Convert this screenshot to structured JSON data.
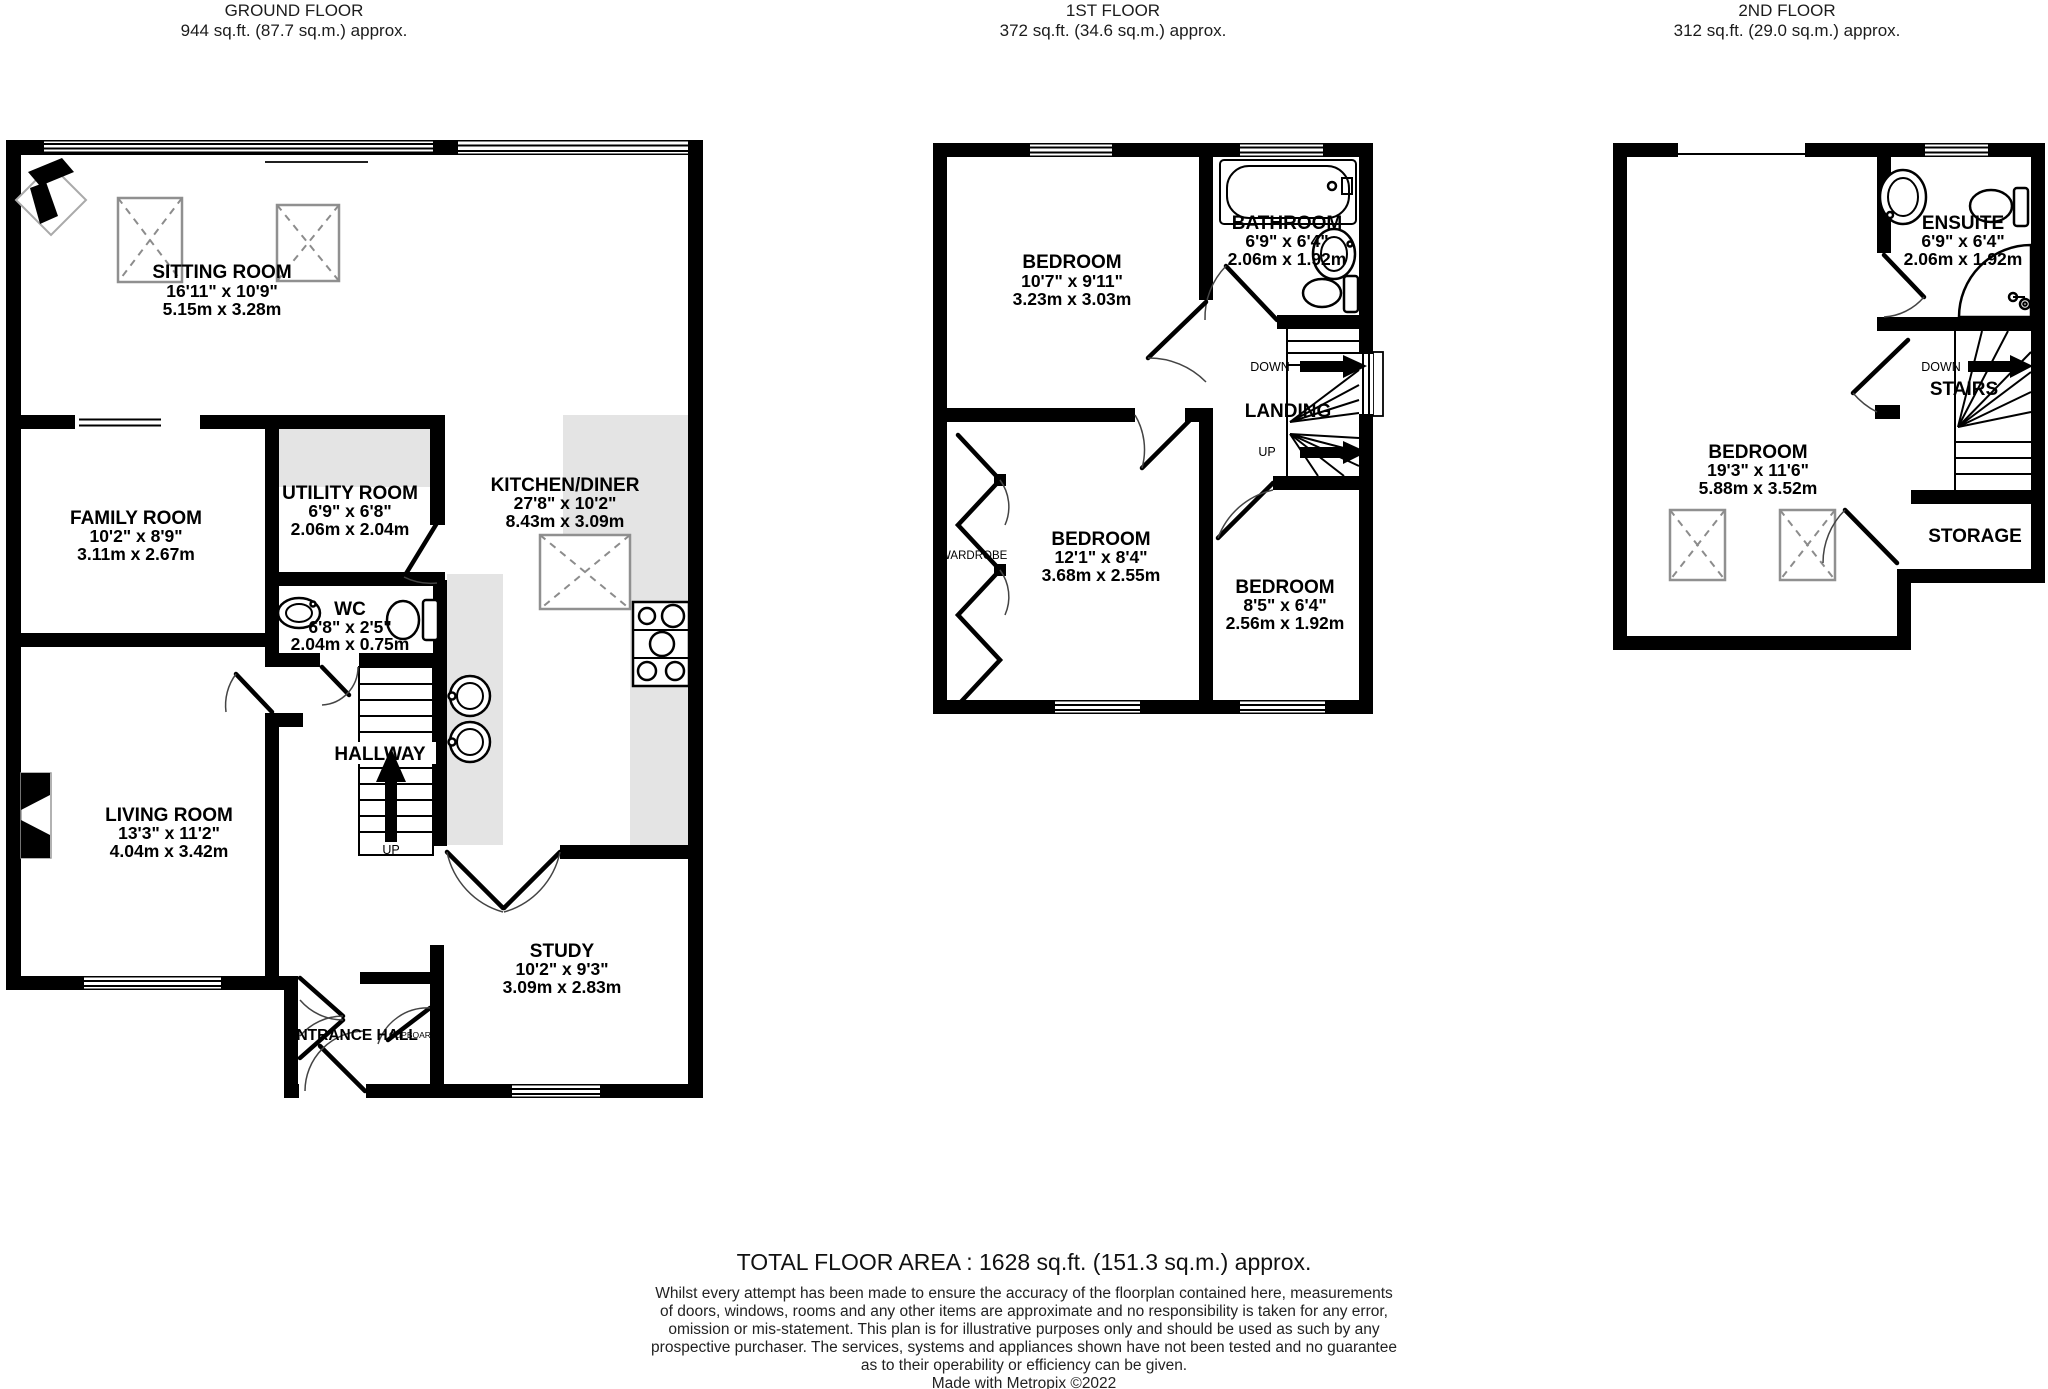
{
  "floors": [
    {
      "name": "GROUND FLOOR",
      "area": "944 sq.ft. (87.7 sq.m.) approx.",
      "rooms": [
        {
          "name": "SITTING ROOM",
          "imperial": "16'11\" x 10'9\"",
          "metric": "5.15m x 3.28m"
        },
        {
          "name": "FAMILY ROOM",
          "imperial": "10'2\" x 8'9\"",
          "metric": "3.11m x 2.67m"
        },
        {
          "name": "UTILITY ROOM",
          "imperial": "6'9\" x 6'8\"",
          "metric": "2.06m x 2.04m"
        },
        {
          "name": "KITCHEN/DINER",
          "imperial": "27'8\" x 10'2\"",
          "metric": "8.43m x 3.09m"
        },
        {
          "name": "WC",
          "imperial": "6'8\" x 2'5\"",
          "metric": "2.04m x 0.75m"
        },
        {
          "name": "LIVING ROOM",
          "imperial": "13'3\" x 11'2\"",
          "metric": "4.04m x 3.42m"
        },
        {
          "name": "STUDY",
          "imperial": "10'2\" x 9'3\"",
          "metric": "3.09m x 2.83m"
        }
      ],
      "labels": {
        "hallway": "HALLWAY",
        "up": "UP",
        "entrance_hall": "ENTRANCE HALL",
        "cupboard": "CUPBOARD"
      }
    },
    {
      "name": "1ST FLOOR",
      "area": "372 sq.ft. (34.6 sq.m.) approx.",
      "rooms": [
        {
          "name": "BEDROOM",
          "imperial": "10'7\" x 9'11\"",
          "metric": "3.23m x 3.03m"
        },
        {
          "name": "BATHROOM",
          "imperial": "6'9\" x 6'4\"",
          "metric": "2.06m x 1.92m"
        },
        {
          "name": "BEDROOM",
          "imperial": "12'1\" x 8'4\"",
          "metric": "3.68m x 2.55m"
        },
        {
          "name": "BEDROOM",
          "imperial": "8'5\" x 6'4\"",
          "metric": "2.56m x 1.92m"
        }
      ],
      "labels": {
        "down": "DOWN",
        "landing": "LANDING",
        "up": "UP",
        "wardrobe": "WARDROBE"
      }
    },
    {
      "name": "2ND FLOOR",
      "area": "312 sq.ft. (29.0 sq.m.) approx.",
      "rooms": [
        {
          "name": "ENSUITE",
          "imperial": "6'9\" x 6'4\"",
          "metric": "2.06m x 1.92m"
        },
        {
          "name": "BEDROOM",
          "imperial": "19'3\" x 11'6\"",
          "metric": "5.88m x 3.52m"
        }
      ],
      "labels": {
        "down": "DOWN",
        "stairs": "STAIRS",
        "storage": "STORAGE"
      }
    }
  ],
  "footer": {
    "total": "TOTAL FLOOR AREA : 1628 sq.ft. (151.3 sq.m.) approx.",
    "disclaimer_lines": [
      "Whilst every attempt has been made to ensure the accuracy of the floorplan contained here, measurements",
      "of doors, windows, rooms and any other items are approximate and no responsibility is taken for any error,",
      "omission or mis-statement. This plan is for illustrative purposes only and should be used as such by any",
      "prospective purchaser. The services, systems and appliances shown have not been tested and no guarantee",
      "as to their operability or efficiency can be given."
    ],
    "credit": "Made with Metropix ©2022"
  }
}
